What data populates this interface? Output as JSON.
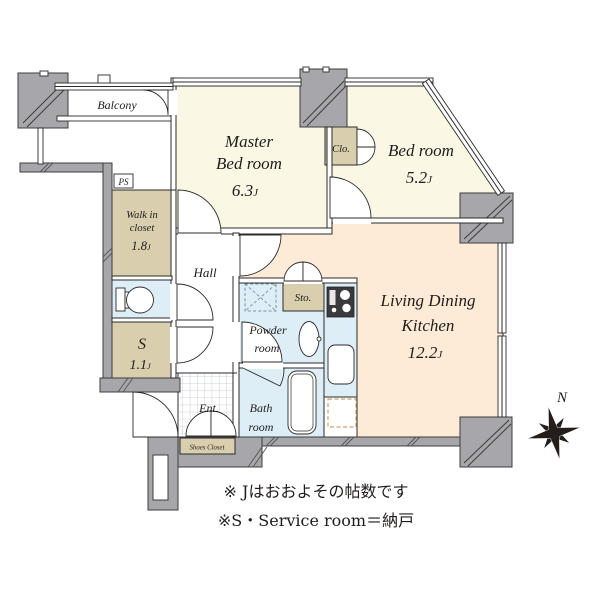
{
  "rooms": {
    "balcony": {
      "label": "Balcony"
    },
    "master_bedroom": {
      "line1": "Master",
      "line2": "Bed room",
      "area": "6.3",
      "unit": "J"
    },
    "bedroom": {
      "name": "Bed room",
      "area": "5.2",
      "unit": "J"
    },
    "ldk": {
      "line1": "Living Dining",
      "line2": "Kitchen",
      "area": "12.2",
      "unit": "J"
    },
    "walk_in_closet": {
      "line1": "Walk in",
      "line2": "closet",
      "area": "1.8",
      "unit": "J"
    },
    "service_room": {
      "name": "S",
      "area": "1.1",
      "unit": "J"
    },
    "hall": {
      "label": "Hall"
    },
    "entrance": {
      "label": "Ent."
    },
    "powder_room": {
      "line1": "Powder",
      "line2": "room"
    },
    "bath_room": {
      "line1": "Bath",
      "line2": "room"
    },
    "closet": {
      "label": "Clo."
    },
    "storage": {
      "label": "Sto."
    },
    "shoes_closet": {
      "label": "Shoes Closet"
    },
    "ps": {
      "label": "PS"
    }
  },
  "compass": {
    "label": "N"
  },
  "notes": {
    "line1": "※ Jはおおよその帖数です",
    "line2": "※S・Service room＝納戸"
  },
  "colors": {
    "cream": "#fbf7e5",
    "peach": "#fdebd8",
    "beige": "#d9cfae",
    "blue": "#ddeef7",
    "wall": "#a7a7ab",
    "tile_line": "#bcc2c8",
    "ink": "#1f1c1a"
  }
}
